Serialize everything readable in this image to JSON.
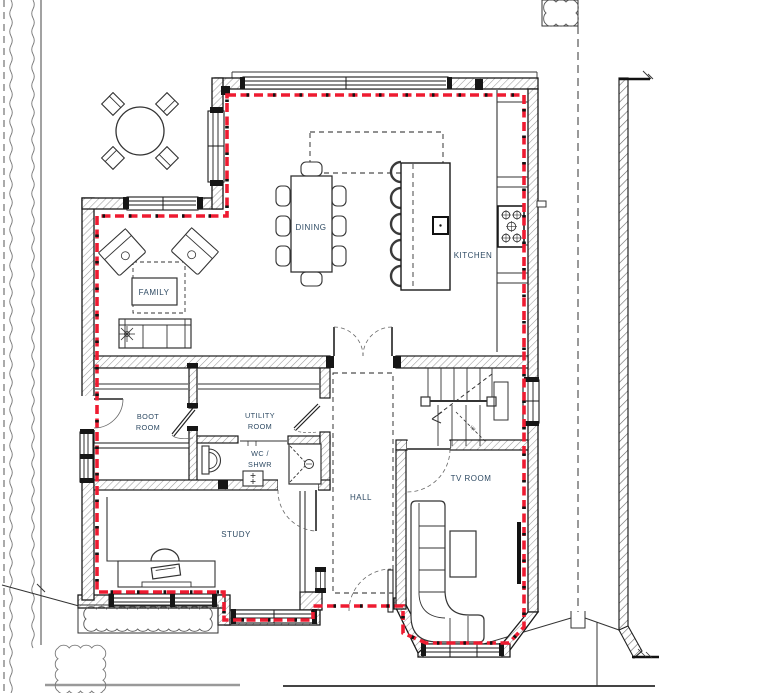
{
  "plan": {
    "rooms": {
      "dining": "DINING",
      "kitchen": "KITCHEN",
      "family": "FAMILY",
      "boot_room": [
        "BOOT",
        "ROOM"
      ],
      "utility_room": [
        "UTILITY",
        "ROOM"
      ],
      "wc_shower": [
        "WC /",
        "SHWR"
      ],
      "hall": "HALL",
      "study": "STUDY",
      "tv_room": "TV ROOM"
    },
    "stairs": {
      "direction_note": "up"
    },
    "colors": {
      "perimeter_highlight": "#ee1b31",
      "room_label": "#2e4a63",
      "wall_line": "#1a1a1a",
      "hatch": "#9a9a9a"
    }
  }
}
